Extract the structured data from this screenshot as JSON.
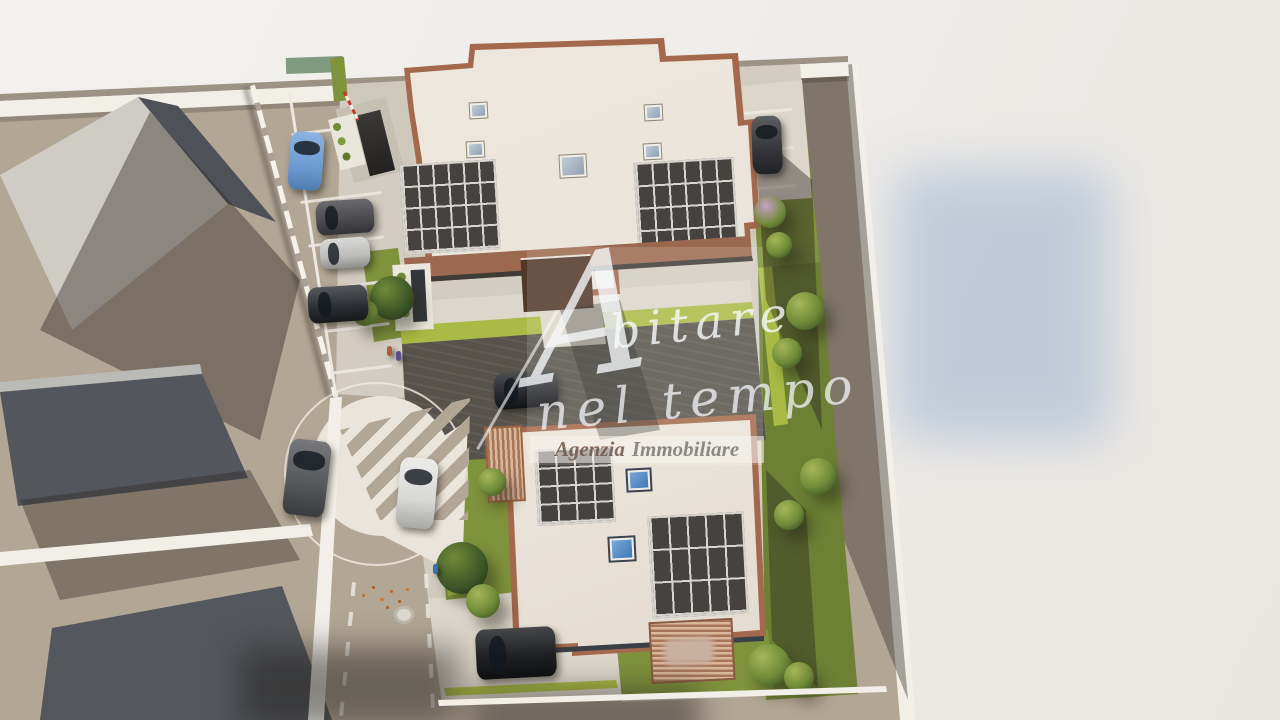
{
  "image_type": "photorealistic 3D aerial rendering of a new residential development (real-estate marketing visual)",
  "watermark": {
    "initial": "A",
    "word_rest": "bitare",
    "line2": "nel tempo",
    "banner_left": "Agenzia",
    "banner_right": "Immobiliare"
  },
  "palette": {
    "bg": "#f1efec",
    "shadowBlue": "#b5c3d6",
    "ground": "#b2a694",
    "pavers": "#d3ccc0",
    "paversLight": "#ddd7cb",
    "roofCream": "#e9e2d8",
    "roofTrim": "#a4684c",
    "roofGray": "#cfccc5",
    "solarDark": "#45423f",
    "solarGrid": "#d8d5d0",
    "grass": "#7f923c",
    "grassDark": "#6d8034",
    "hedge": "#a9bb45",
    "treeLight": "#a7b65a",
    "treeMid": "#6f8a38",
    "treeDark": "#3c5526",
    "wallWhite": "#f2efe8",
    "roadLine": "#ece9e1",
    "driveDark": "#57534c",
    "wood": "#a7765a",
    "woodLight": "#d9b79a",
    "carBlue": "#6d9bd1",
    "carSilver": "#bcbcba",
    "carDark": "#4a4a4e",
    "carBlack": "#1f2124",
    "carWhite": "#d8d8d5",
    "canopyBrown": "#503728",
    "skylightBlue": "#4d86c8"
  },
  "scene": {
    "buildings": [
      {
        "name": "building-north",
        "roof": "flat cream roof with terracotta perimeter trim",
        "solar_arrays": 2,
        "array_grids": [
          "6x4",
          "6x4"
        ],
        "skylights": 5
      },
      {
        "name": "building-south",
        "roof": "flat cream roof with terracotta trim and dark fascia",
        "solar_arrays": 2,
        "array_grids": [
          "4x4",
          "5x3"
        ],
        "skylights": 2,
        "extras": [
          "wooden pergola with outdoor furniture",
          "small timber deck"
        ]
      }
    ],
    "neighboring_buildings": 3,
    "cars": [
      {
        "color": "blue",
        "location": "street stall top-left"
      },
      {
        "color": "dark gray",
        "location": "parking stall left"
      },
      {
        "color": "silver",
        "location": "parking stall left"
      },
      {
        "color": "black",
        "location": "parking stall left"
      },
      {
        "color": "gray",
        "location": "road beside traffic island"
      },
      {
        "color": "white",
        "location": "road beside traffic island"
      },
      {
        "color": "dark gray",
        "location": "parking bay right of north building"
      },
      {
        "color": "black SUV",
        "location": "driveway bottom"
      },
      {
        "color": "black",
        "location": "courtyard driveway"
      }
    ],
    "road_features": [
      "teardrop traffic island with white zebra stripes",
      "white circular guide line",
      "dashed lane markings",
      "manhole cover",
      "scattered autumn leaves",
      "parking stall lines",
      "red-white barrier at garage ramp"
    ],
    "vegetation": [
      "boundary hedges",
      "lawn gardens",
      "round trees",
      "flowering pink shrub"
    ],
    "people_count": 3,
    "background": "blank off-white studio backdrop with soft blue-gray reflection at right"
  }
}
